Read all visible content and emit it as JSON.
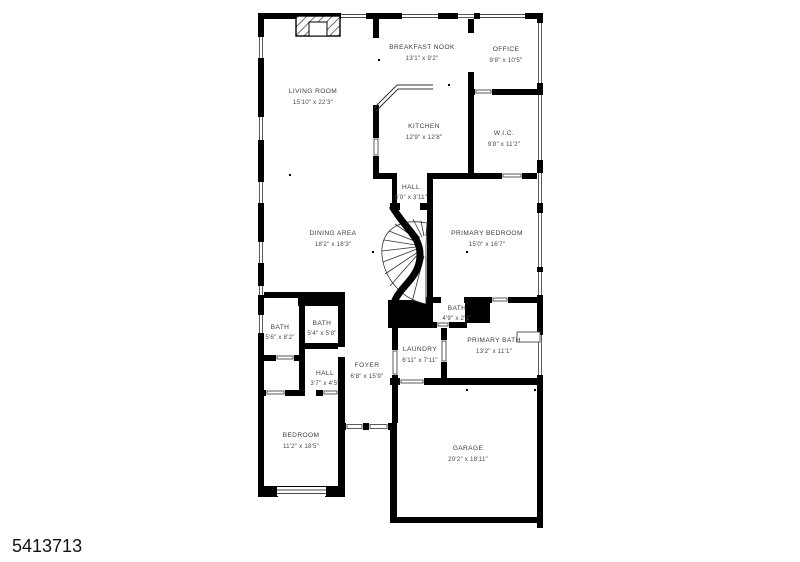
{
  "listing_id": "5413713",
  "floorplan": {
    "rooms": [
      {
        "name": "LIVING ROOM",
        "dims": "15'10\" x 22'3\""
      },
      {
        "name": "BREAKFAST NOOK",
        "dims": "13'1\" x 9'2\""
      },
      {
        "name": "OFFICE",
        "dims": "9'8\" x 10'5\""
      },
      {
        "name": "KITCHEN",
        "dims": "12'9\" x 12'8\""
      },
      {
        "name": "W.I.C.",
        "dims": "9'8\" x 11'2\""
      },
      {
        "name": "HALL",
        "dims": "5'0\" x 3'11\""
      },
      {
        "name": "DINING AREA",
        "dims": "18'2\" x 18'3\""
      },
      {
        "name": "PRIMARY BEDROOM",
        "dims": "15'0\" x 16'7\""
      },
      {
        "name": "BATH",
        "dims": "4'9\" x 2'1\""
      },
      {
        "name": "BATH",
        "dims": "5'6\" x 8'2\""
      },
      {
        "name": "BATH",
        "dims": "5'4\" x 5'8\""
      },
      {
        "name": "PRIMARY BATH",
        "dims": "13'2\" x 11'1\""
      },
      {
        "name": "LAUNDRY",
        "dims": "6'11\" x 7'11\""
      },
      {
        "name": "FOYER",
        "dims": "6'8\" x 15'9\""
      },
      {
        "name": "HALL",
        "dims": "3'7\" x 4'5\""
      },
      {
        "name": "BEDROOM",
        "dims": "11'2\" x 18'5\""
      },
      {
        "name": "GARAGE",
        "dims": "20'2\" x 18'11\""
      }
    ],
    "colors": {
      "wall": "#000000",
      "background": "#ffffff",
      "label": "#3c3c3c"
    }
  }
}
